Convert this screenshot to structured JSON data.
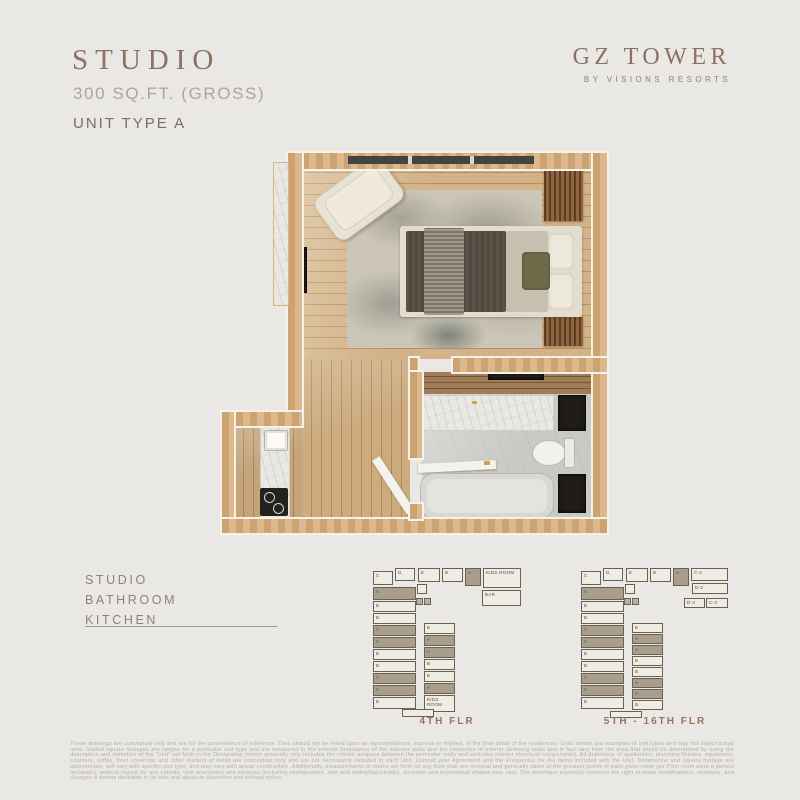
{
  "header": {
    "title": "STUDIO",
    "area": "300 SQ.FT. (GROSS)",
    "unit_type": "UNIT TYPE A",
    "brand_name": "GZ TOWER",
    "brand_tagline": "BY VISIONS RESORTS"
  },
  "colors": {
    "background": "#e9e8e4",
    "title_brown": "#8c7164",
    "wall_tan": "#d8ae7c",
    "keyplan_highlight": "#a99d8b",
    "keyplan_label": "#9b7164"
  },
  "legend": {
    "items": [
      "STUDIO",
      "BATHROOM",
      "KITCHEN"
    ]
  },
  "keyplans": [
    {
      "label": "4TH FLR",
      "cells": [
        {
          "x": 1,
          "y": 3,
          "w": 20,
          "h": 14,
          "label": "C"
        },
        {
          "x": 23,
          "y": 0,
          "w": 20,
          "h": 13,
          "label": "D"
        },
        {
          "x": 46,
          "y": 0,
          "w": 22,
          "h": 14,
          "label": "E"
        },
        {
          "x": 70,
          "y": 0,
          "w": 21,
          "h": 14,
          "label": "B"
        },
        {
          "x": 93,
          "y": 0,
          "w": 16,
          "h": 18,
          "label": "A",
          "hl": true
        },
        {
          "x": 111,
          "y": 0,
          "w": 38,
          "h": 20,
          "label": "KIDS ROOM"
        },
        {
          "x": 110,
          "y": 22,
          "w": 39,
          "h": 16,
          "label": "BAR"
        },
        {
          "x": 45,
          "y": 16,
          "w": 10,
          "h": 10,
          "label": ""
        },
        {
          "x": 44,
          "y": 30,
          "w": 7,
          "h": 7,
          "label": "",
          "fill": "gray"
        },
        {
          "x": 52,
          "y": 30,
          "w": 7,
          "h": 7,
          "label": "",
          "fill": "gray"
        },
        {
          "x": 1,
          "y": 19,
          "w": 43,
          "h": 13,
          "label": "A",
          "hl": true
        },
        {
          "x": 1,
          "y": 33,
          "w": 43,
          "h": 11,
          "label": "B"
        },
        {
          "x": 1,
          "y": 45,
          "w": 43,
          "h": 11,
          "label": "B"
        },
        {
          "x": 1,
          "y": 57,
          "w": 43,
          "h": 11,
          "label": "A",
          "hl": true
        },
        {
          "x": 1,
          "y": 69,
          "w": 43,
          "h": 11,
          "label": "A",
          "hl": true
        },
        {
          "x": 1,
          "y": 81,
          "w": 43,
          "h": 11,
          "label": "B"
        },
        {
          "x": 1,
          "y": 93,
          "w": 43,
          "h": 11,
          "label": "B"
        },
        {
          "x": 1,
          "y": 105,
          "w": 43,
          "h": 11,
          "label": "A",
          "hl": true
        },
        {
          "x": 1,
          "y": 117,
          "w": 43,
          "h": 11,
          "label": "A",
          "hl": true
        },
        {
          "x": 1,
          "y": 129,
          "w": 43,
          "h": 12,
          "label": "B"
        },
        {
          "x": 52,
          "y": 55,
          "w": 31,
          "h": 11,
          "label": "B"
        },
        {
          "x": 52,
          "y": 67,
          "w": 31,
          "h": 11,
          "label": "A",
          "hl": true
        },
        {
          "x": 52,
          "y": 79,
          "w": 31,
          "h": 11,
          "label": "A",
          "hl": true
        },
        {
          "x": 52,
          "y": 91,
          "w": 31,
          "h": 11,
          "label": "B"
        },
        {
          "x": 52,
          "y": 103,
          "w": 31,
          "h": 11,
          "label": "B"
        },
        {
          "x": 52,
          "y": 115,
          "w": 31,
          "h": 11,
          "label": "A",
          "hl": true
        },
        {
          "x": 52,
          "y": 127,
          "w": 31,
          "h": 17,
          "label": "KIDS ROOM"
        },
        {
          "x": 30,
          "y": 141,
          "w": 32,
          "h": 8,
          "label": ""
        }
      ]
    },
    {
      "label": "5TH - 16TH FLR",
      "cells": [
        {
          "x": 1,
          "y": 3,
          "w": 20,
          "h": 14,
          "label": "C"
        },
        {
          "x": 23,
          "y": 0,
          "w": 20,
          "h": 13,
          "label": "D"
        },
        {
          "x": 46,
          "y": 0,
          "w": 22,
          "h": 14,
          "label": "E"
        },
        {
          "x": 70,
          "y": 0,
          "w": 21,
          "h": 14,
          "label": "B"
        },
        {
          "x": 93,
          "y": 0,
          "w": 16,
          "h": 18,
          "label": "A",
          "hl": true
        },
        {
          "x": 111,
          "y": 0,
          "w": 37,
          "h": 13,
          "label": "C-2"
        },
        {
          "x": 112,
          "y": 15,
          "w": 36,
          "h": 11,
          "label": "D-2"
        },
        {
          "x": 104,
          "y": 30,
          "w": 21,
          "h": 10,
          "label": "D-3"
        },
        {
          "x": 126,
          "y": 30,
          "w": 22,
          "h": 10,
          "label": "C-3"
        },
        {
          "x": 45,
          "y": 16,
          "w": 10,
          "h": 10,
          "label": ""
        },
        {
          "x": 44,
          "y": 30,
          "w": 7,
          "h": 7,
          "label": "",
          "fill": "gray"
        },
        {
          "x": 52,
          "y": 30,
          "w": 7,
          "h": 7,
          "label": "",
          "fill": "gray"
        },
        {
          "x": 1,
          "y": 19,
          "w": 43,
          "h": 13,
          "label": "A",
          "hl": true
        },
        {
          "x": 1,
          "y": 33,
          "w": 43,
          "h": 11,
          "label": "B"
        },
        {
          "x": 1,
          "y": 45,
          "w": 43,
          "h": 11,
          "label": "B"
        },
        {
          "x": 1,
          "y": 57,
          "w": 43,
          "h": 11,
          "label": "A",
          "hl": true
        },
        {
          "x": 1,
          "y": 69,
          "w": 43,
          "h": 11,
          "label": "A",
          "hl": true
        },
        {
          "x": 1,
          "y": 81,
          "w": 43,
          "h": 11,
          "label": "B"
        },
        {
          "x": 1,
          "y": 93,
          "w": 43,
          "h": 11,
          "label": "B"
        },
        {
          "x": 1,
          "y": 105,
          "w": 43,
          "h": 11,
          "label": "A",
          "hl": true
        },
        {
          "x": 1,
          "y": 117,
          "w": 43,
          "h": 11,
          "label": "A",
          "hl": true
        },
        {
          "x": 1,
          "y": 129,
          "w": 43,
          "h": 12,
          "label": "B"
        },
        {
          "x": 52,
          "y": 55,
          "w": 31,
          "h": 10,
          "label": "B"
        },
        {
          "x": 52,
          "y": 66,
          "w": 31,
          "h": 10,
          "label": "A",
          "hl": true
        },
        {
          "x": 52,
          "y": 77,
          "w": 31,
          "h": 10,
          "label": "A",
          "hl": true
        },
        {
          "x": 52,
          "y": 88,
          "w": 31,
          "h": 10,
          "label": "B"
        },
        {
          "x": 52,
          "y": 99,
          "w": 31,
          "h": 10,
          "label": "B"
        },
        {
          "x": 52,
          "y": 110,
          "w": 31,
          "h": 10,
          "label": "A",
          "hl": true
        },
        {
          "x": 52,
          "y": 121,
          "w": 31,
          "h": 10,
          "label": "A",
          "hl": true
        },
        {
          "x": 52,
          "y": 132,
          "w": 31,
          "h": 10,
          "label": "B"
        },
        {
          "x": 30,
          "y": 143,
          "w": 32,
          "h": 7,
          "label": ""
        }
      ]
    }
  ],
  "disclaimer": "These drawings are conceptual only and are for the convenience of reference.  They should not be relied upon as representations, express or implied, of the final detail of the residences.  Units shown are examples of unit types and may not depict actual units.  Stated square footages are ranges for a particular unit type and are measured to the exterior boundaries of the exterior walls and the centerline of interior demising walls and in fact vary from the area that would be determined by using the description and definition of the \"Unit\" set forth in the Declaration (which generally only includes the interior airspace between the perimeter walls and excludes interior structural components).  All depictions of appliances, plumbing fixtures, equipment, counters, soffits, floor coverings and other matters of detail are conceptual only and are not necessarily included in each Unit.  Consult your Agreement and the Prospectus for the items included with the Unit.  Dimensions and square footage are approximate, will vary with specific unit type, and may vary with actual construction.  Additionally, measurements of rooms set forth on any floor plan are nominal and generally taken at the greatest points of each given room (as if the room were a perfect rectangle), without regard for any cutouts.  Unit orientation and windows (including configuration, size and railing/balustrade), structure and mechanical chases may vary.  The developer expressly reserves the right to make modifications, revisions, and changes it deems desirable in its sole and absolute discretion and without notice."
}
